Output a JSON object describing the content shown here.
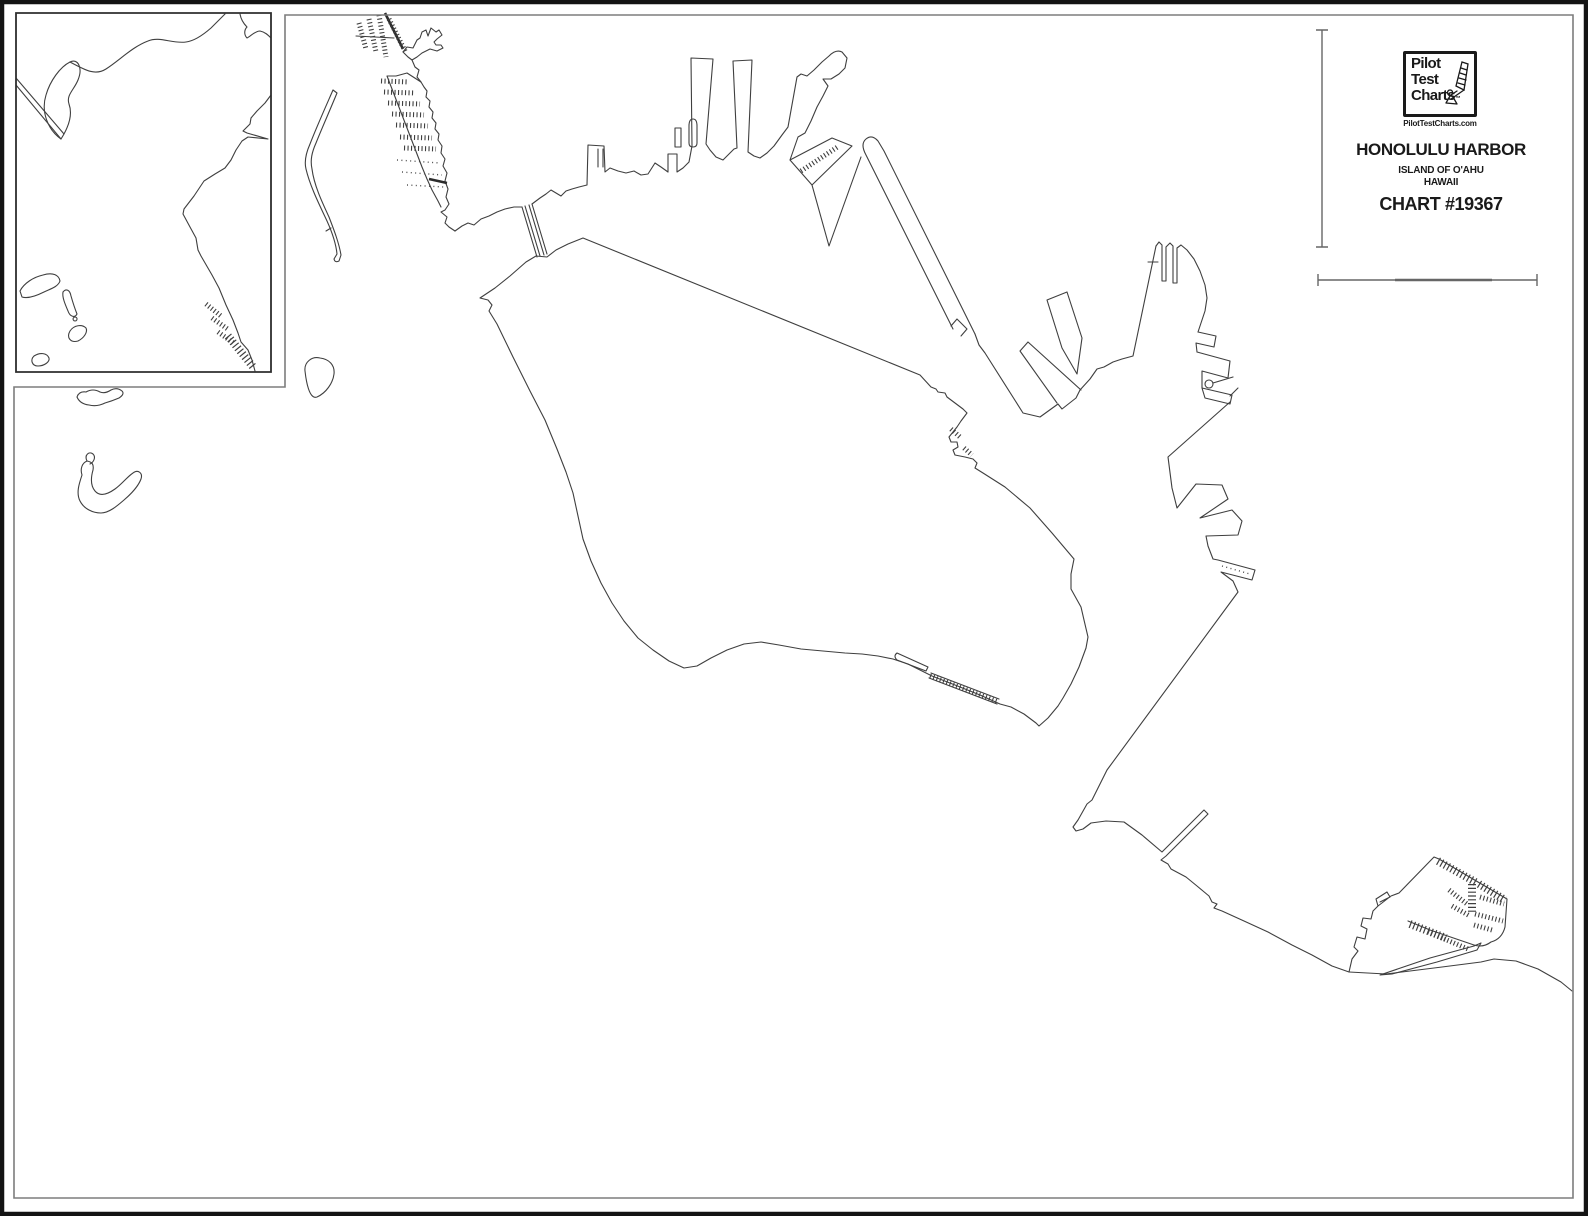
{
  "logo": {
    "line1": "Pilot",
    "line2": "Test",
    "line3": "Charts",
    "trademark": "™",
    "website": "PilotTestCharts.com",
    "icon": "windsurfer-sailboat-icon"
  },
  "title_block": {
    "title": "HONOLULU HARBOR",
    "subtitle_line1": "ISLAND OF O'AHU",
    "subtitle_line2": "HAWAII",
    "chart_number": "CHART #19367"
  },
  "colors": {
    "coastline": "#3f3f3f",
    "outer_frame": "#141414",
    "neatline_gray": "#7d7d7d",
    "background": "#ffffff"
  },
  "map_paths": {
    "frame": [
      {
        "name": "outer-frame",
        "cls": "frame",
        "d": "M2,2 L1586,2 L1586,1214 L2,1214 Z"
      },
      {
        "name": "map-neatline",
        "cls": "neat",
        "d": "M285,387 L285,15 L1573,15 L1573,1198 L14,1198 L14,387 Z"
      },
      {
        "name": "inset-box-border",
        "cls": "inset-border",
        "d": "M16,13 L271,13 L271,372 L16,372 Z"
      }
    ],
    "main": [
      {
        "name": "nw-marina-dock-1",
        "cls": "comb-sm",
        "d": "M359,23 L366,49"
      },
      {
        "name": "nw-marina-dock-2",
        "cls": "comb-sm",
        "d": "M369,19 L376,52"
      },
      {
        "name": "nw-marina-dock-3",
        "cls": "comb-sm",
        "d": "M379,15 L386,57"
      },
      {
        "name": "nw-marina-crossbar",
        "cls": "coast",
        "d": "M356,36 L394,38"
      },
      {
        "name": "nw-marina-main-pier",
        "cls": "thick",
        "d": "M385,13 L403,49"
      },
      {
        "name": "nw-marina-pier-comb",
        "cls": "comb-sm",
        "d": "M389,19 L406,53"
      },
      {
        "name": "nw-headland",
        "cls": "coast",
        "d": "M403,52 L407,47 L413,48 L417,40 L420,38 L422,32 L426,30 L428,36 L431,28 L436,32 L439,30 L442,35 L437,39 L434,42 L436,45 L441,45 L443,48 L437,51 L430,49 L422,53 L417,57 L412,60 L408,57 Z"
      },
      {
        "name": "nw-shore-upper",
        "cls": "coast",
        "d": "M412,60 L415,67 L419,70 L417,77 L421,82"
      },
      {
        "name": "terminal-strip-east-edge",
        "cls": "coast",
        "d": "M421,82 L424,87 L427,91 L426,97 L430,101 L429,107 L433,112 L432,118 L436,123 L435,129 L439,134 L438,140 L442,146 L441,153 L445,159 L443,166 L447,173 L445,181 L448,189 L446,197 L449,204 L445,210 L441,212 L447,217 L445,223 L449,227 L455,231"
      },
      {
        "name": "terminal-strip-west-edge",
        "cls": "coast",
        "d": "M421,82 L407,73 L396,76 L387,76 L392,89 L397,102 L402,115 L407,128 L412,141 L417,154 L422,167 L427,179 L432,190 L438,201 L441,207"
      },
      {
        "name": "terminal-pier-row-1",
        "cls": "comb-sm",
        "d": "M381,81 L409,82"
      },
      {
        "name": "terminal-pier-row-2",
        "cls": "comb-sm",
        "d": "M384,92 L415,93"
      },
      {
        "name": "terminal-pier-row-3",
        "cls": "comb-sm",
        "d": "M388,103 L420,104"
      },
      {
        "name": "terminal-pier-row-4",
        "cls": "comb-sm",
        "d": "M392,114 L424,115"
      },
      {
        "name": "terminal-pier-row-5",
        "cls": "comb-sm",
        "d": "M396,125 L428,126"
      },
      {
        "name": "terminal-pier-row-6",
        "cls": "comb-sm",
        "d": "M400,137 L432,138"
      },
      {
        "name": "terminal-pier-row-7",
        "cls": "comb-sm",
        "d": "M404,148 L436,149"
      },
      {
        "name": "terminal-dotted-row-1",
        "cls": "dots",
        "d": "M397,160 L440,163"
      },
      {
        "name": "terminal-dotted-row-2",
        "cls": "dots",
        "d": "M402,172 L442,175"
      },
      {
        "name": "terminal-dotted-row-3",
        "cls": "dots",
        "d": "M407,185 L444,187"
      },
      {
        "name": "terminal-dark-bar",
        "cls": "thick",
        "d": "M429,179 L447,183"
      },
      {
        "name": "north-shore-to-bridge",
        "cls": "coast",
        "d": "M455,231 L462,226 L468,223 L474,225 L481,219 L489,216 L497,212 L505,209 L514,207 L522,207"
      },
      {
        "name": "sand-island-bridge",
        "cls": "coast",
        "d": "M522,207 L537,257 M525,206 L540,256 M529,205 L544,255 M532,204 L547,254"
      },
      {
        "name": "north-waterfront-piers",
        "cls": "coast",
        "d": "M532,204 L540,198 L546,194 L551,190 L556,193 L561,196 L566,191 L572,189 L579,187 L587,185 L588,145 L604,146 L605,172 L610,168 L618,171 L626,173 L634,171 L641,175 L648,174 L655,163 L661,167 L668,172 L668,154 L677,154 L677,172 L683,168 L689,162 L692,146 L691,58 L713,59 L706,144 L710,150 L716,157 L723,160 L729,154 L734,149 L737,148 L733,61 L752,60 L748,152 L754,156 L760,158 L767,153 L774,146 L782,135 L788,127 L797,77 L801,74 L807,76 L814,70 L822,62 L829,56 Q836,49 842,52 L847,58 L845,68 L839,74 L831,79 L823,79 L828,86 L823,96 L817,107 L811,121 L805,133 L798,137 L790,160"
      },
      {
        "name": "pier-slip-slit",
        "cls": "coast",
        "d": "M598,149 L598,167 M603,149 L603,167"
      },
      {
        "name": "floating-pier-thin",
        "cls": "coast",
        "d": "M675,147 L675,128 L681,128 L681,147 Z"
      },
      {
        "name": "floating-pier-capsule",
        "cls": "coast",
        "d": "M689,143 L689,126 Q689,119 693,119 Q697,119 697,126 L697,143 Q697,147 693,147 Q689,147 689,143 Z"
      },
      {
        "name": "diagonal-wharf",
        "cls": "coast",
        "d": "M790,160 L832,138 L852,146 L812,185 Z"
      },
      {
        "name": "diagonal-wharf-gangway",
        "cls": "comb-sm",
        "d": "M801,171 L839,146"
      },
      {
        "name": "wharf-slip-shore",
        "cls": "coast",
        "d": "M812,185 L829,246 L861,157"
      },
      {
        "name": "long-pier-one",
        "cls": "coast",
        "d": "M953,329 L866,155 Q860,144 866,139 Q872,134 878,141 L884,151 L975,334"
      },
      {
        "name": "long-pier-end-notch",
        "cls": "coast",
        "d": "M951,326 L957,319 L967,329 L961,336"
      },
      {
        "name": "kapalama-channel-ne-shore",
        "cls": "coast",
        "d": "M975,334 L979,345 L985,353 L1023,413 L1040,417 L1058,404 L1062,409 L1076,398 L1080,390 L1090,379 L1097,369 L1104,367 L1113,362 L1122,359 L1133,356 L1156,246"
      },
      {
        "name": "ne-angled-pier-left",
        "cls": "coast",
        "d": "M1028,342 L1020,351 L1057,403 M1028,342 L1081,390"
      },
      {
        "name": "ne-angled-pier-right",
        "cls": "coast",
        "d": "M1047,300 L1067,292 L1082,338 L1077,374 L1062,348 Z"
      },
      {
        "name": "east-peninsula-slips",
        "cls": "coast",
        "d": "M1156,246 L1159,242 L1162,245 L1162,281 L1166,281 L1166,247 L1170,243 L1173,246 L1173,283 L1177,283 L1177,248 L1181,245 L1187,250 L1194,259 L1200,271 L1205,285 L1207,298 L1205,311 L1201,323 L1198,332"
      },
      {
        "name": "east-peninsula-tick",
        "cls": "coast",
        "d": "M1148,262 L1158,262"
      },
      {
        "name": "peninsula-jut-upper",
        "cls": "coast",
        "d": "M1198,332 L1216,336 L1214,347 L1196,343 L1197,352"
      },
      {
        "name": "peninsula-jut-lower",
        "cls": "coast",
        "d": "M1197,352 L1230,361 L1228,378 L1202,371 L1202,388"
      },
      {
        "name": "beacon-circle",
        "cls": "coast",
        "d": "M1205,384 a4,4 0 1 0 8,0 a4,4 0 1 0 -8,0 M1213,383 L1233,377"
      },
      {
        "name": "peninsula-small-quad",
        "cls": "coast",
        "d": "M1202,388 L1232,395 L1230,404 L1205,398 Z M1230,396 L1238,388"
      },
      {
        "name": "southeast-coastline",
        "cls": "coast",
        "d": "M1230,402 L1168,457 L1172,488 L1177,508 L1196,484 L1222,485 L1228,499 L1200,518 L1232,510 L1242,521 L1238,535 L1206,536 L1208,546 L1213,559 L1218,560 L1255,570 L1252,580 L1221,572 L1233,581 L1238,592 L1107,770 L1092,800 L1087,804 L1078,820 L1073,827 L1076,831 L1083,829 L1091,823 L1106,821 L1124,822 L1142,835 L1162,852 L1204,810 L1208,814 L1166,856 L1161,860 L1168,864 L1171,869 L1186,877 L1197,886 L1203,891 L1209,896 L1212,902 L1217,904 L1214,908 L1222,911 L1244,921 L1268,932 L1292,945 L1312,955 L1332,966 L1349,972"
      },
      {
        "name": "dotted-pier-centerline",
        "cls": "dots",
        "d": "M1222,566 L1250,574"
      },
      {
        "name": "marina-basin-outline",
        "cls": "coast",
        "d": "M1349,972 L1352,959 L1358,951 L1354,947 L1357,937 L1365,939 L1367,929 L1361,926 L1363,918 L1371,919 L1373,911 L1378,906 L1376,899 L1387,892 L1390,897 L1380,902 M1378,906 L1391,896 L1399,893 L1434,857 L1439,859 L1478,882 L1507,899 L1505,927 Q1502,939 1491,942 Q1483,948 1474,945 L1430,930 L1408,921"
      },
      {
        "name": "marina-breakwater-spit",
        "cls": "coast",
        "d": "M1380,975 L1430,958 L1474,946 L1481,943 L1477,950 L1437,962 L1392,974 Z"
      },
      {
        "name": "marina-dock-top-1",
        "cls": "comb",
        "d": "M1438,861 L1477,883"
      },
      {
        "name": "marina-dock-top-2",
        "cls": "comb",
        "d": "M1479,884 L1505,900"
      },
      {
        "name": "marina-dock-vertical",
        "cls": "comb",
        "d": "M1472,884 L1472,912"
      },
      {
        "name": "marina-dock-h1",
        "cls": "comb-sm",
        "d": "M1480,897 L1504,904"
      },
      {
        "name": "marina-dock-h2",
        "cls": "comb-sm",
        "d": "M1475,914 L1503,921"
      },
      {
        "name": "marina-dock-h3",
        "cls": "comb-sm",
        "d": "M1474,925 L1492,930"
      },
      {
        "name": "marina-dock-angled-1",
        "cls": "comb-sm",
        "d": "M1449,890 L1467,904"
      },
      {
        "name": "marina-dock-angled-2",
        "cls": "comb-sm",
        "d": "M1452,906 L1470,916"
      },
      {
        "name": "marina-dock-low-1",
        "cls": "comb",
        "d": "M1410,924 L1446,938"
      },
      {
        "name": "marina-dock-low-2",
        "cls": "comb-sm",
        "d": "M1428,932 L1468,949"
      },
      {
        "name": "outer-coast-bottom-right",
        "cls": "coast",
        "d": "M1349,972 L1386,974 L1442,967 L1481,962 L1494,959 L1516,961 L1538,969 L1561,982 L1572,991"
      },
      {
        "name": "sand-island-outline",
        "cls": "coast",
        "d": "M480,298 L488,300 L492,305 L489,311 L497,324 L513,357 L530,391 L545,420 L557,449 L566,472 L573,493 L578,516 L583,539 L591,561 L601,583 L612,603 L624,621 L638,638 L653,650 L669,661 L684,668 L697,666 L711,658 L727,650 L744,644 L761,642 L779,645 L801,649 L823,651 L845,653 L862,654 L878,656 L893,659 L908,664 L922,671 L932,676 L955,685 L980,695 L1000,704 L1011,707 L1024,714 L1036,723 L1039,726 L1048,718 L1058,706 L1063,698 L1071,684 L1079,667 L1086,648 L1088,637 L1084,620 L1081,607 L1071,589 L1071,574 L1074,559 L1052,533 L1030,508 L1005,487 L983,473 L975,468 L977,463 L973,459 L965,457 L955,455 L953,450 L958,447 L957,442 L951,442 L949,437 L957,427 L961,421 L967,413 L963,409 L947,397 L945,393 L938,392 L936,389 L931,387 L920,375 L583,238 L568,244 L556,250 L547,257 L536,256 L526,262 L510,276 L495,288 Z"
      },
      {
        "name": "sand-island-mole",
        "cls": "coast",
        "d": "M897,660 Q893,656 897,653 L928,667 L926,671 Z"
      },
      {
        "name": "sand-island-causeway-a",
        "cls": "coast",
        "d": "M931,673 L999,699"
      },
      {
        "name": "sand-island-causeway-b",
        "cls": "coast",
        "d": "M929,678 L997,704"
      },
      {
        "name": "sand-island-causeway-hatch",
        "cls": "comb-sm",
        "d": "M930,676 L998,702"
      },
      {
        "name": "sand-island-dock-1",
        "cls": "comb-sm",
        "d": "M951,429 L960,437"
      },
      {
        "name": "sand-island-dock-2",
        "cls": "comb-sm",
        "d": "M964,448 L972,455"
      },
      {
        "name": "west-islet-small",
        "cls": "coast",
        "d": "M77,397 Q79,391 86,392 Q93,388 100,392 Q105,394 111,390 Q117,387 122,391 Q125,394 119,398 Q112,401 105,403 Q97,407 89,405 Q80,404 77,397 Z"
      },
      {
        "name": "west-islet-crescent",
        "cls": "coast",
        "d": "M87,461 C82,463 80,469 82,475 C79,484 76,493 80,501 C84,509 93,513 101,513 C109,513 117,506 124,500 C131,494 138,487 141,479 C143,473 138,469 133,473 C127,477 122,484 115,489 C108,494 100,497 95,491 C90,485 91,477 93,470 C94,464 92,462 87,461 Z"
      },
      {
        "name": "west-islet-curl",
        "cls": "coast",
        "d": "M87,461 C84,455 89,451 93,454 C96,457 94,462 90,464"
      },
      {
        "name": "mid-islet",
        "cls": "coast",
        "d": "M305,371 C304,362 312,356 320,358 C329,359 335,365 334,374 C333,383 326,393 317,397 C309,400 306,380 305,371 Z"
      },
      {
        "name": "thin-spit-island",
        "cls": "coast",
        "d": "M333,90 C326,106 317,126 310,144 C306,153 304,161 306,169 C310,186 319,204 327,221 C332,232 336,244 337,254 L334,259 Q335,263 339,261 L341,255 C339,243 334,230 329,217 C322,202 314,185 312,169 C310,160 312,152 316,143 C322,128 330,110 337,93 Z"
      },
      {
        "name": "thin-spit-notch",
        "cls": "coast",
        "d": "M331,228 L326,231"
      },
      {
        "name": "vertical-scale-bar",
        "cls": "sbar",
        "d": "M1322,30 L1322,247 M1316,30 L1328,30 M1316,247 L1328,247"
      },
      {
        "name": "horizontal-scale-bar",
        "cls": "sbar",
        "d": "M1318,280 L1537,280 M1318,274 L1318,286 M1537,274 L1537,286"
      },
      {
        "name": "horizontal-scale-segment",
        "cls": "sbar-thick",
        "d": "M1395,280 L1492,280"
      }
    ],
    "inset": [
      {
        "name": "inset-channel-double-line",
        "cls": "coast",
        "d": "M16,78 L64,134 M16,85 L61,139"
      },
      {
        "name": "inset-west-blob",
        "cls": "coast",
        "d": "M61,139 C47,129 41,111 46,95 C50,81 60,67 70,62 C78,58 83,68 78,80 C74,90 66,95 69,104 C73,115 68,128 61,139 Z"
      },
      {
        "name": "inset-north-coast",
        "cls": "coast",
        "d": "M70,62 C85,70 95,76 106,69 C120,60 132,47 148,41 C160,36 172,44 186,42 C194,41 203,35 211,28 L225,14"
      },
      {
        "name": "inset-northeast-corner-coast",
        "cls": "coast",
        "d": "M240,14 C241,20 244,24 247,27 C244,30 244,35 247,38 C251,36 255,31 260,31 C265,32 268,35 271,38"
      },
      {
        "name": "inset-east-coast",
        "cls": "coast",
        "d": "M271,95 L265,103 L257,111 L251,118 L250,124 L243,131 L247,133 L268,139 L248,137 L242,141 L236,150 L231,160 L225,168 L215,174 L204,181 L194,196 L184,209 L183,214 L190,227 L196,238 L198,250 L201,256 L212,275 L219,288 L226,305 L233,320 L238,333 L241,342 L248,350 L252,360 L255,371"
      },
      {
        "name": "inset-pier-comb-1",
        "cls": "comb-sm",
        "d": "M206,304 L221,316"
      },
      {
        "name": "inset-pier-comb-2",
        "cls": "comb-sm",
        "d": "M212,318 L229,330"
      },
      {
        "name": "inset-pier-comb-3",
        "cls": "comb-sm",
        "d": "M218,332 L235,344"
      },
      {
        "name": "inset-pier-ladder",
        "cls": "comb",
        "d": "M228,336 L254,368"
      },
      {
        "name": "inset-island-a",
        "cls": "coast",
        "d": "M20,291 C24,283 34,277 43,275 C53,272 59,275 60,281 C58,287 50,289 44,292 C36,296 28,299 22,297 Z"
      },
      {
        "name": "inset-island-b",
        "cls": "coast",
        "d": "M63,292 C66,288 70,290 71,296 C73,303 75,309 77,314 C75,318 70,317 68,311 C65,304 62,297 63,292 Z"
      },
      {
        "name": "inset-island-dot",
        "cls": "coast",
        "d": "M75,317 a2,2 0 1 0 0.1,0 Z"
      },
      {
        "name": "inset-island-c",
        "cls": "coast",
        "d": "M70,331 C74,325 82,324 86,328 C88,332 84,338 78,341 C71,343 66,338 70,331 Z"
      },
      {
        "name": "inset-island-d",
        "cls": "coast",
        "d": "M34,356 C40,352 47,353 49,358 C50,362 44,366 38,366 C32,366 30,360 34,356 Z"
      }
    ]
  }
}
